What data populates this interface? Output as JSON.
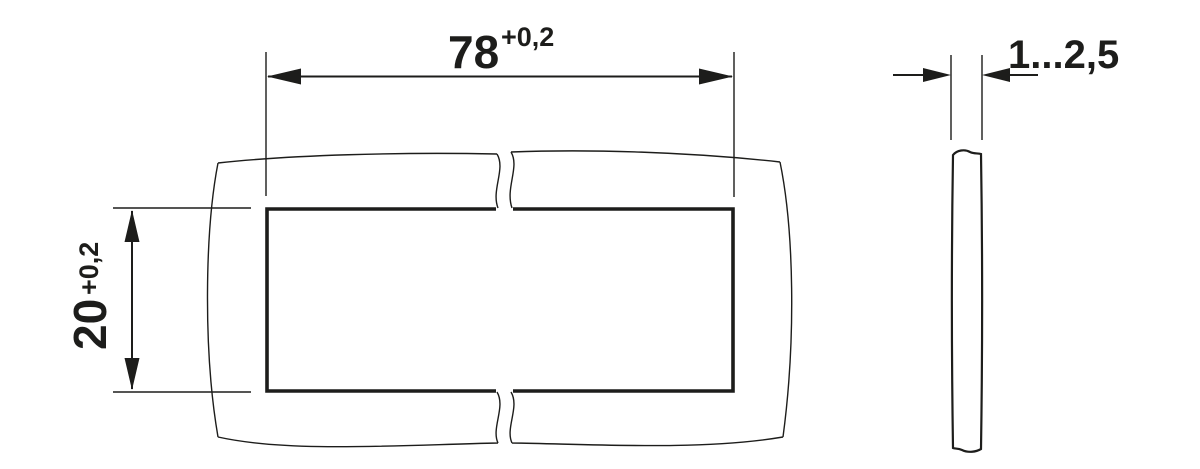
{
  "app": {
    "type": "panel-cutout-technical-drawing",
    "background_color": "#ffffff",
    "line_color": "#1d1d1b"
  },
  "front_view": {
    "width_dimension": {
      "value": "78",
      "tolerance": "+0,2"
    },
    "height_dimension": {
      "value": "20",
      "tolerance": "+0,2"
    }
  },
  "side_view": {
    "thickness_dimension": {
      "value": "1...2,5"
    }
  }
}
